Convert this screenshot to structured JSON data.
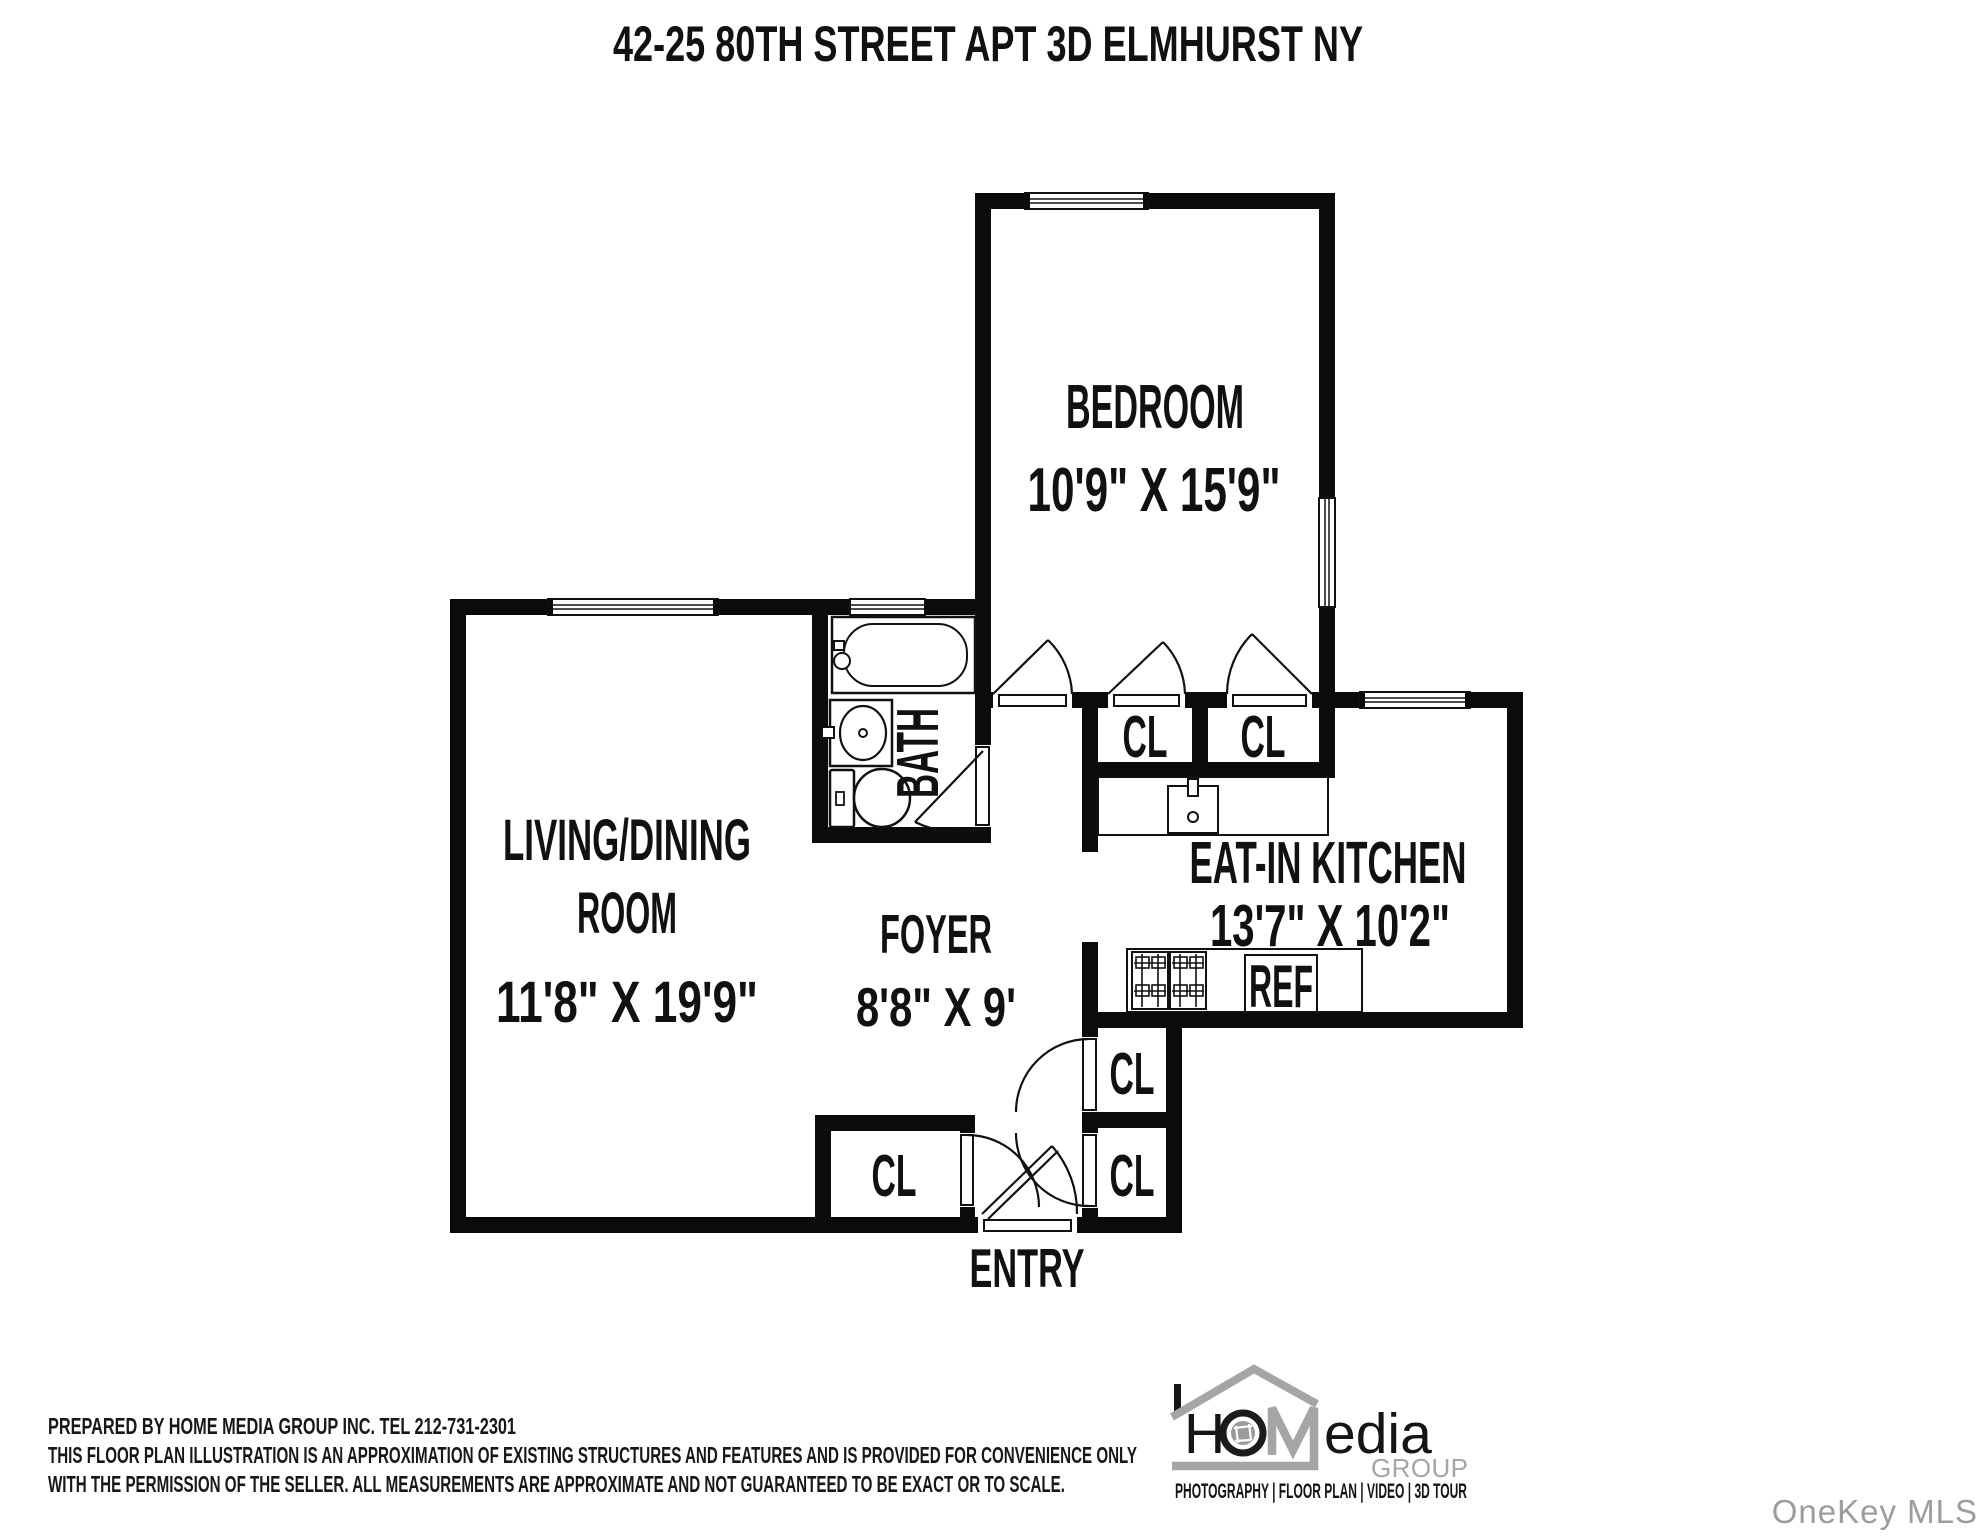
{
  "title": "42-25 80TH STREET APT 3D ELMHURST NY",
  "rooms": {
    "bedroom": {
      "name": "BEDROOM",
      "dims": "10'9\" X 15'9\""
    },
    "living": {
      "name_line1": "LIVING/DINING",
      "name_line2": "ROOM",
      "dims": "11'8\" X 19'9\""
    },
    "foyer": {
      "name": "FOYER",
      "dims": "8'8\" X 9'"
    },
    "kitchen": {
      "name": "EAT-IN KITCHEN",
      "dims": "13'7\" X 10'2\""
    },
    "bath": {
      "name": "BATH"
    }
  },
  "labels": {
    "closet": "CL",
    "refrigerator": "REF",
    "entry": "ENTRY"
  },
  "footer": {
    "prepared_by": "PREPARED BY  HOME MEDIA GROUP INC.  TEL 212-731-2301",
    "disclaimer_line1": "THIS FLOOR PLAN ILLUSTRATION IS AN APPROXIMATION OF EXISTING STRUCTURES AND FEATURES AND IS PROVIDED FOR CONVENIENCE ONLY",
    "disclaimer_line2": "WITH THE PERMISSION OF THE SELLER. ALL MEASUREMENTS ARE APPROXIMATE AND NOT GUARANTEED TO BE EXACT OR TO SCALE."
  },
  "logo": {
    "text_h": "H",
    "text_edia": "edia",
    "text_group": "GROUP",
    "services": "PHOTOGRAPHY | FLOOR PLAN | VIDEO | 3D TOUR"
  },
  "watermark": "OneKey MLS",
  "colors": {
    "wall": "#0b0b0b",
    "line": "#111111",
    "logo_gray": "#a5a5a5",
    "watermark_gray": "#9b9ca0"
  }
}
